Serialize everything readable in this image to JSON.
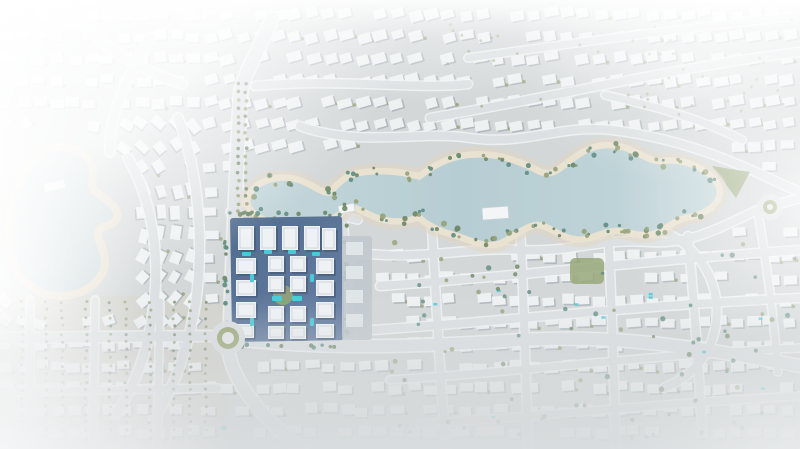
{
  "image": {
    "kind": "aerial-masterplan-render",
    "width": 800,
    "height": 449
  },
  "palette": {
    "ground": "#cfd3d4",
    "ground_warm": "#cdc8ba",
    "road_core": "#d9dddf",
    "road_edge": "#f0f2f3",
    "water_light": "#bdd2d6",
    "water_mid": "#aec8cf",
    "sand": "#e8dfcc",
    "sand_outer": "#ded2bc",
    "olive": "#8a9767",
    "olive_dark": "#5d7a55",
    "teal": "#4d7f74",
    "cluster_base_a": "#3e5c82",
    "cluster_base_b": "#56719a",
    "building": "#eef1f3",
    "building_shadow": "#2e4664",
    "pool": "#35c4d4",
    "villa": "#edf0f1",
    "villa_shadow": "#9fa9b0",
    "annex": "#b9c2c9",
    "annex_villa": "#dde2e5",
    "roundabout_green": "#8fa06a",
    "park_green": "#8da06c",
    "lake_fill": "#c6d5d8"
  },
  "scene": {
    "w": 800,
    "h": 449,
    "sw_warm_rect": [
      0,
      296,
      228,
      153
    ],
    "exclusions": {
      "ellipses": [
        [
          290,
          202,
          62,
          38
        ],
        [
          385,
          193,
          60,
          39
        ],
        [
          475,
          196,
          92,
          54
        ],
        [
          585,
          192,
          92,
          54
        ],
        [
          672,
          196,
          70,
          48
        ],
        [
          58,
          222,
          70,
          95
        ],
        [
          730,
          182,
          30,
          22
        ],
        [
          228,
          338,
          26,
          26
        ],
        [
          770,
          207,
          20,
          20
        ]
      ],
      "rects": [
        [
          222,
          210,
          156,
          142
        ]
      ]
    },
    "villa_grid": {
      "x0": 6,
      "y0": 14,
      "dx": 17,
      "dy": 22,
      "jitter": 2.5,
      "skip": 0.12
    },
    "roads": [
      {
        "d": "M 272,18 C 260,50 243,72 240,98 L 235,208 L 230,330",
        "w": 13
      },
      {
        "d": "M 228,348 C 232,382 262,418 302,449",
        "w": 12
      },
      {
        "d": "M 0,338 L 212,336",
        "w": 10
      },
      {
        "d": "M 245,340 C 330,350 430,346 520,340 C 620,334 700,348 800,366",
        "w": 12
      },
      {
        "d": "M 352,252 C 420,262 470,246 520,250 C 570,253 600,238 650,242 C 692,245 722,226 758,210 L 800,198",
        "w": 8
      },
      {
        "d": "M 300,126 C 360,148 420,130 470,138 C 525,146 560,124 612,130 C 662,136 705,150 742,166 C 768,177 784,186 800,192",
        "w": 8
      },
      {
        "d": "M 430,118 C 550,98 680,66 800,52",
        "w": 8
      },
      {
        "d": "M 468,58 C 580,42 700,26 800,16",
        "w": 7
      },
      {
        "d": "M 255,86 C 340,78 420,90 468,84",
        "w": 8
      },
      {
        "d": "M 432,228 C 436,300 440,380 446,449",
        "w": 8
      },
      {
        "d": "M 520,226 C 524,300 526,380 528,449",
        "w": 8
      },
      {
        "d": "M 608,230 C 612,300 614,380 616,449",
        "w": 8
      },
      {
        "d": "M 688,236 C 694,300 698,360 702,424",
        "w": 8
      },
      {
        "d": "M 758,214 C 768,270 774,320 778,372",
        "w": 7
      },
      {
        "d": "M 380,286 C 500,278 650,260 800,250",
        "w": 8
      },
      {
        "d": "M 372,330 C 500,322 650,304 800,298",
        "w": 8
      },
      {
        "d": "M 390,380 C 520,372 660,354 800,348",
        "w": 7
      },
      {
        "d": "M 420,424 C 540,416 680,402 800,396",
        "w": 7
      },
      {
        "d": "M 128,158 C 152,200 162,258 152,318 C 147,352 136,384 116,414",
        "w": 9
      },
      {
        "d": "M 178,118 C 198,168 204,240 196,300 C 190,342 176,384 154,420",
        "w": 9
      },
      {
        "d": "M 150,38 C 122,88 108,120 110,152",
        "w": 9
      },
      {
        "d": "M 62,0 C 92,40 132,68 182,84",
        "w": 9
      },
      {
        "d": "M 30,300 L 30,449",
        "w": 7
      },
      {
        "d": "M 95,300 L 93,449",
        "w": 7
      },
      {
        "d": "M 160,302 L 157,449",
        "w": 7
      },
      {
        "d": "M 0,392 L 218,388",
        "w": 7
      },
      {
        "d": "M 240,332 C 292,318 330,288 354,254",
        "w": 7
      },
      {
        "d": "M 230,212 C 270,206 320,210 358,220",
        "w": 7
      },
      {
        "d": "M 344,222 L 352,338",
        "w": 6
      },
      {
        "d": "M 605,95 C 650,105 700,118 742,140",
        "w": 7
      },
      {
        "d": "M 660,230 C 710,250 726,300 712,340 C 704,362 688,378 664,388",
        "w": 8
      }
    ],
    "lagoon_path": "M 252,196 C 258,184 278,178 295,182 C 310,186 318,196 330,196 C 340,188 345,178 360,176 C 385,172 405,176 420,180 C 435,168 450,160 470,158 C 495,156 510,162 525,168 C 535,172 540,178 552,176 C 565,172 572,160 590,152 C 605,146 620,148 632,154 C 645,160 652,166 665,164 C 680,162 695,168 706,176 C 714,182 718,188 716,196 C 712,206 700,212 688,214 C 675,216 668,224 655,230 C 640,236 628,226 612,228 C 598,230 588,238 575,236 C 562,234 552,224 540,222 C 528,220 515,232 500,240 C 486,246 470,236 455,232 C 440,228 428,222 420,214 C 408,218 395,220 382,216 C 368,212 360,204 348,204 C 338,212 328,220 312,222 C 295,224 272,222 260,214 C 252,208 248,202 252,196 Z",
    "lake_path": "M 50,148 C 70,144 88,152 92,166 C 96,178 88,186 96,192 C 104,198 112,202 116,210 C 120,218 114,224 106,226 C 98,228 96,232 100,242 C 104,254 108,262 102,274 C 94,288 78,296 60,296 C 40,296 22,284 14,264 C 6,244 8,216 14,196 C 20,176 32,154 50,148 Z",
    "pier": [
      44,
      184,
      20,
      8,
      -12
    ],
    "decks": [
      [
        482,
        208,
        26,
        12,
        -4
      ],
      [
        338,
        206,
        16,
        8,
        -10
      ]
    ],
    "shore_trees": [
      [
        252,
        192
      ],
      [
        270,
        180
      ],
      [
        295,
        180
      ],
      [
        330,
        193
      ],
      [
        352,
        176
      ],
      [
        378,
        172
      ],
      [
        405,
        176
      ],
      [
        432,
        170
      ],
      [
        455,
        160
      ],
      [
        480,
        156
      ],
      [
        505,
        160
      ],
      [
        528,
        168
      ],
      [
        552,
        174
      ],
      [
        572,
        162
      ],
      [
        592,
        152
      ],
      [
        615,
        147
      ],
      [
        635,
        154
      ],
      [
        658,
        163
      ],
      [
        680,
        163
      ],
      [
        700,
        170
      ],
      [
        712,
        178
      ],
      [
        258,
        212
      ],
      [
        278,
        220
      ],
      [
        300,
        222
      ],
      [
        322,
        221
      ],
      [
        345,
        206
      ],
      [
        362,
        205
      ],
      [
        382,
        216
      ],
      [
        402,
        219
      ],
      [
        420,
        215
      ],
      [
        438,
        228
      ],
      [
        455,
        232
      ],
      [
        472,
        236
      ],
      [
        492,
        240
      ],
      [
        512,
        232
      ],
      [
        530,
        222
      ],
      [
        548,
        224
      ],
      [
        565,
        235
      ],
      [
        585,
        236
      ],
      [
        605,
        229
      ],
      [
        625,
        229
      ],
      [
        645,
        233
      ],
      [
        662,
        230
      ],
      [
        680,
        216
      ],
      [
        695,
        213
      ]
    ],
    "median_trees": {
      "x": [
        238,
        246
      ],
      "y0": 84,
      "y1": 212,
      "step": 8
    },
    "sw_tree_cols": {
      "cols": [
        22,
        46,
        62,
        86,
        110,
        126,
        150,
        174,
        190,
        206
      ],
      "y0": 302,
      "y1": 444,
      "step": 8
    },
    "scatter": {
      "count": 95,
      "x0": 360,
      "y0": 228,
      "x1": 796,
      "y1": 440
    },
    "scatter_top": {
      "count": 42,
      "x0": 430,
      "y0": 18,
      "x1": 796,
      "y1": 118
    },
    "park_block": [
      570,
      258,
      34,
      26
    ],
    "cluster": {
      "base": [
        230,
        218,
        112,
        124
      ],
      "annex": [
        342,
        236,
        30,
        104
      ],
      "buildings": [
        [
          238,
          226,
          16,
          24
        ],
        [
          260,
          226,
          16,
          24
        ],
        [
          282,
          226,
          16,
          24
        ],
        [
          304,
          226,
          16,
          24
        ],
        [
          322,
          228,
          14,
          22
        ],
        [
          236,
          258,
          20,
          16
        ],
        [
          236,
          280,
          20,
          16
        ],
        [
          236,
          302,
          20,
          16
        ],
        [
          236,
          324,
          18,
          14
        ],
        [
          268,
          256,
          16,
          16
        ],
        [
          290,
          256,
          16,
          16
        ],
        [
          268,
          276,
          16,
          16
        ],
        [
          290,
          276,
          16,
          16
        ],
        [
          268,
          306,
          16,
          16
        ],
        [
          290,
          306,
          16,
          16
        ],
        [
          268,
          326,
          16,
          13
        ],
        [
          290,
          326,
          16,
          13
        ],
        [
          316,
          258,
          18,
          16
        ],
        [
          316,
          280,
          18,
          16
        ],
        [
          316,
          302,
          18,
          16
        ],
        [
          316,
          324,
          18,
          14
        ]
      ],
      "pools": [
        [
          242,
          252,
          9,
          4
        ],
        [
          264,
          250,
          8,
          4
        ],
        [
          288,
          250,
          8,
          4
        ],
        [
          312,
          252,
          8,
          4
        ],
        [
          250,
          274,
          4,
          8
        ],
        [
          310,
          274,
          4,
          8
        ],
        [
          250,
          318,
          4,
          8
        ],
        [
          310,
          318,
          4,
          8
        ],
        [
          272,
          296,
          10,
          5
        ],
        [
          292,
          296,
          10,
          5
        ]
      ],
      "annex_villas": [
        [
          346,
          242,
          17,
          13
        ],
        [
          346,
          266,
          17,
          13
        ],
        [
          346,
          290,
          17,
          13
        ],
        [
          346,
          314,
          17,
          13
        ]
      ],
      "courtyard": [
        283,
        295,
        10
      ]
    },
    "roundabouts": [
      [
        228,
        338,
        15
      ],
      [
        770,
        207,
        11
      ]
    ],
    "park_wedge": "M 712,166 L 750,172 L 736,198 Z",
    "pool_dot": [
      224,
      428,
      3
    ]
  }
}
